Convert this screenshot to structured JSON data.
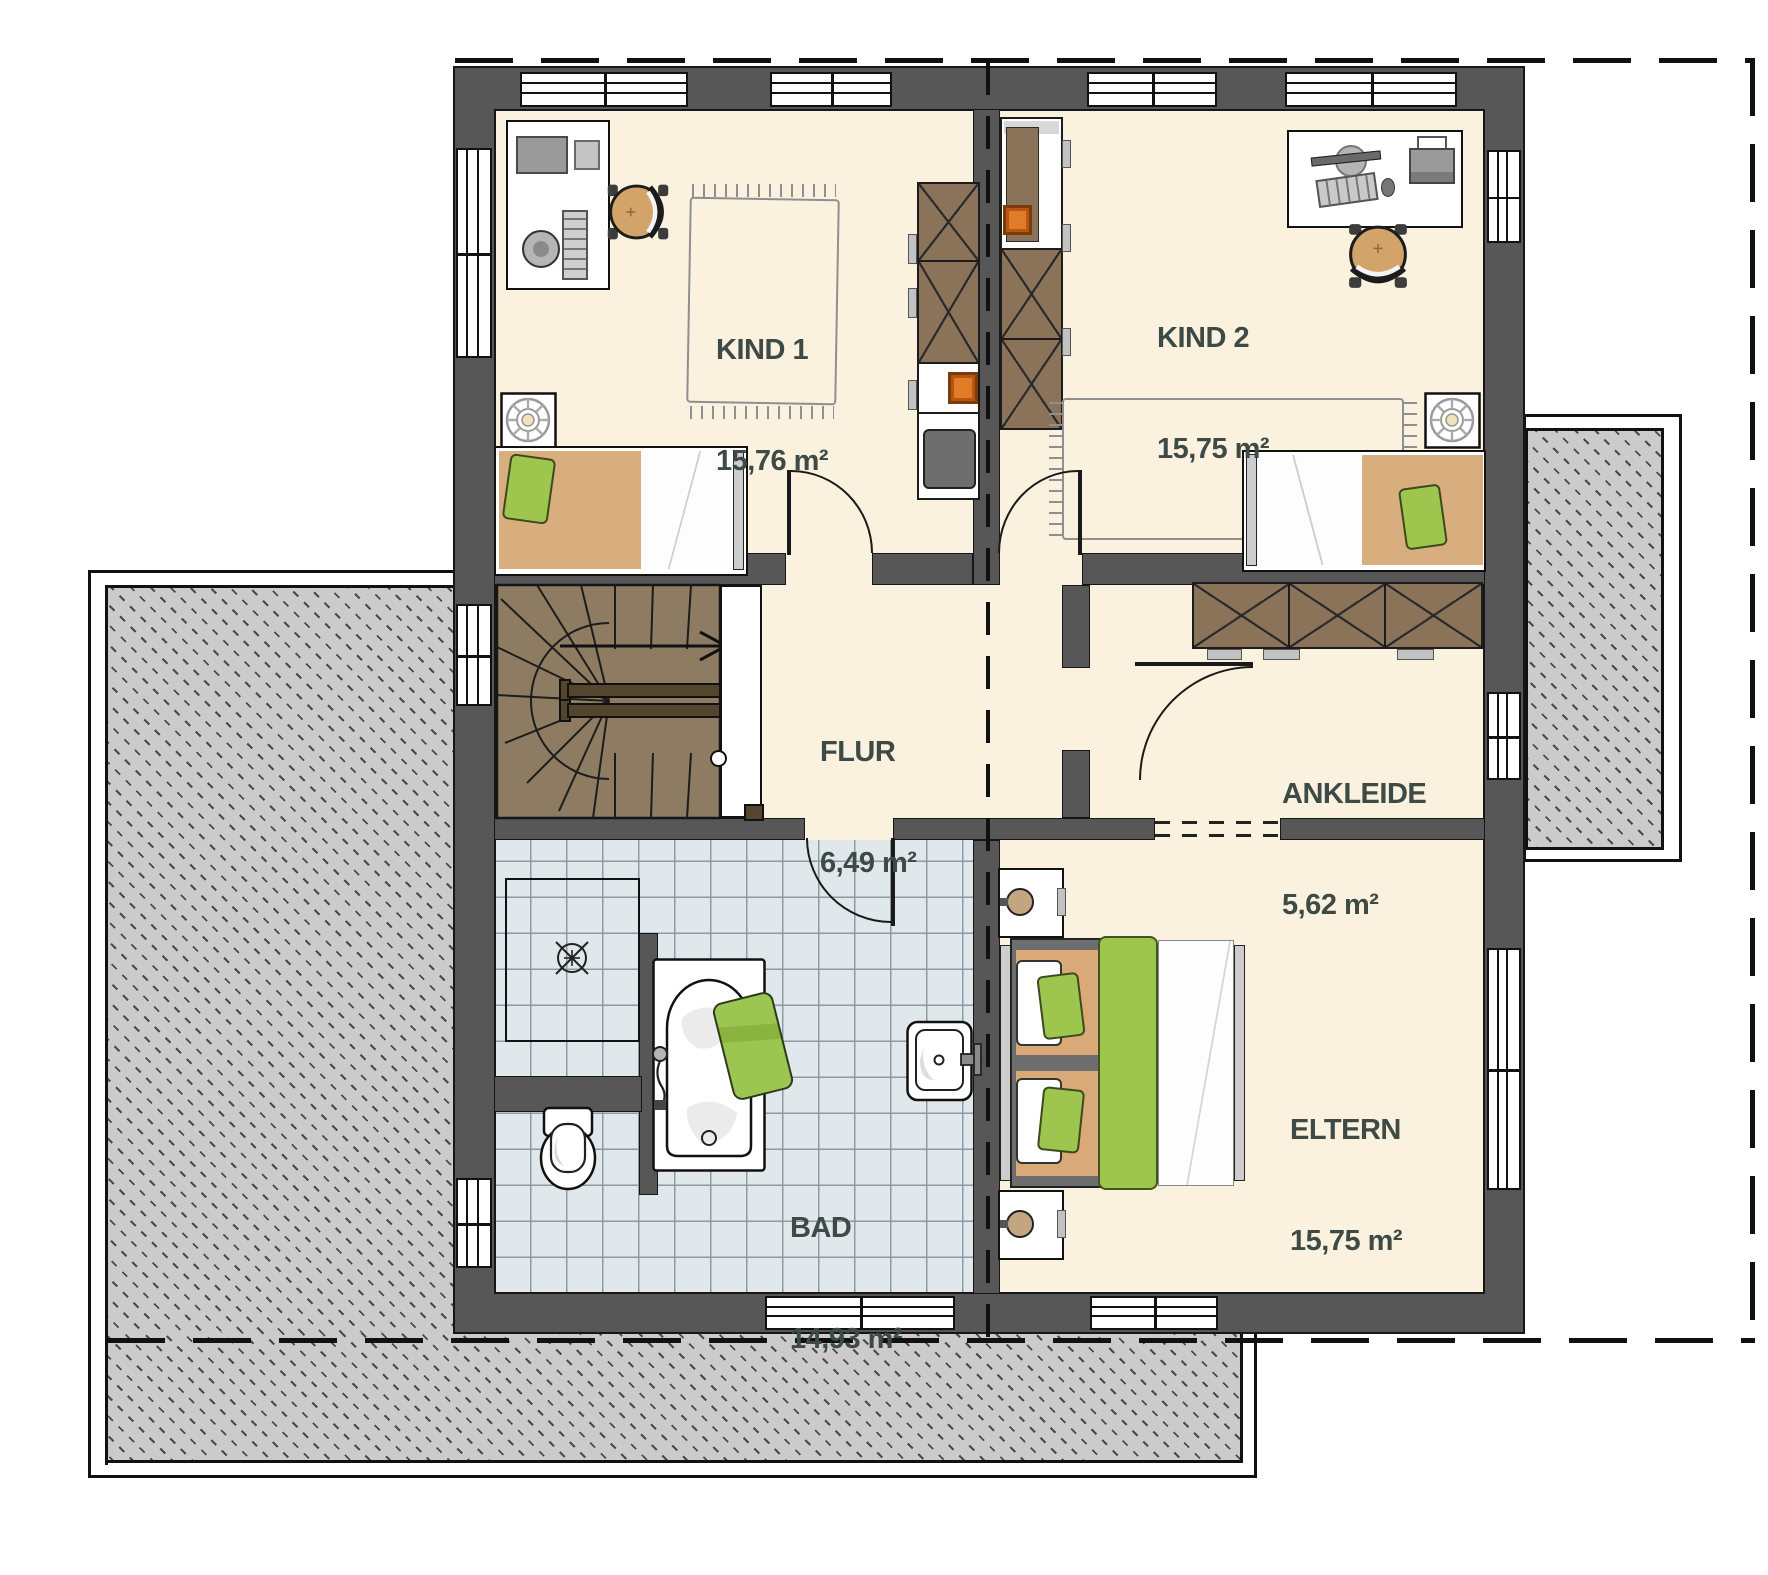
{
  "rooms": [
    {
      "name": "KIND 1",
      "area": "15,76 m²"
    },
    {
      "name": "KIND 2",
      "area": "15,75 m²"
    },
    {
      "name": "FLUR",
      "area": "6,49 m²"
    },
    {
      "name": "ANKLEIDE",
      "area": "5,62 m²"
    },
    {
      "name": "ELTERN",
      "area": "15,75 m²"
    },
    {
      "name": "BAD",
      "area": "14,93 m²"
    }
  ],
  "colors": {
    "wall": "#575757",
    "floor": "#faf2df",
    "tile": "#e1e8ec",
    "hatch": "#cbcbcb",
    "stair_wood": "#8d7c61",
    "wardrobe_wood": "#8a7358",
    "accent_green": "#9ec64f",
    "accent_tan": "#d9ae7e",
    "accent_orange": "#e07b28",
    "label_text": "#3e4a45"
  }
}
